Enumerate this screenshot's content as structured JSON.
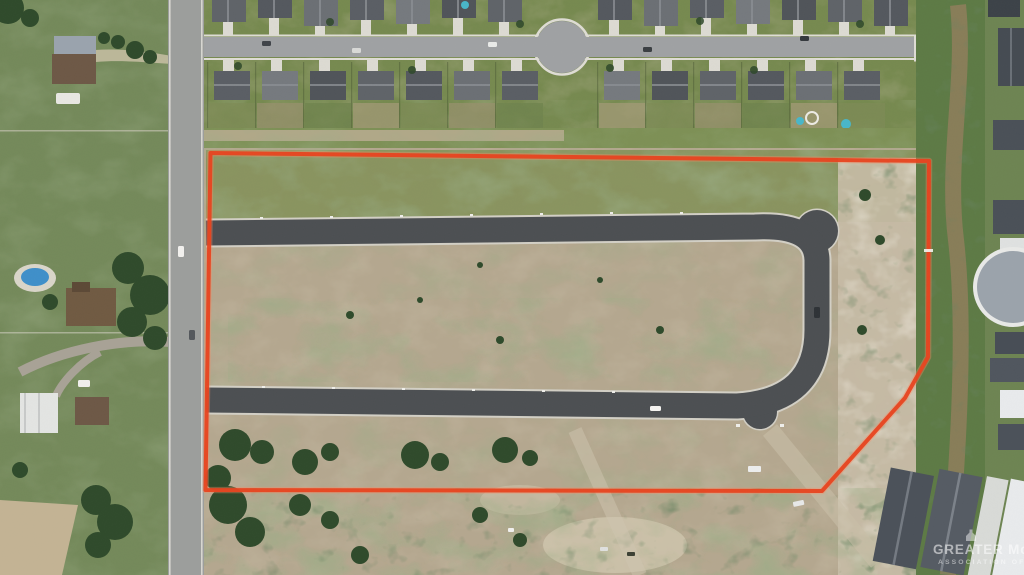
{
  "meta": {
    "title": "Aerial photo of vacant platted subdivision parcel outlined in red",
    "width": 1024,
    "height": 575
  },
  "watermark": {
    "logo": "realtor-emblem",
    "line1": "GREATER McALLEN",
    "line2": "ASSOCIATION OF REALTORS"
  },
  "boundary": {
    "label": "property-boundary-outline",
    "color": "#e8431f"
  },
  "palette": {
    "dirt": "#b4a78f",
    "pale_dirt": "#c6bba6",
    "new_asphalt": "#4c4f52",
    "old_asphalt": "#9fa1a3",
    "curb": "#d2cfc5",
    "grass": "#76894f",
    "rural_field": "#74895a",
    "tree": "#2f4a2b",
    "roof_dark": "#565a60",
    "roof_white": "#e8eaec",
    "pool_blue": "#49b6c8",
    "drainage_green": "#5d7a45",
    "channel_brown": "#8d7d5a"
  }
}
